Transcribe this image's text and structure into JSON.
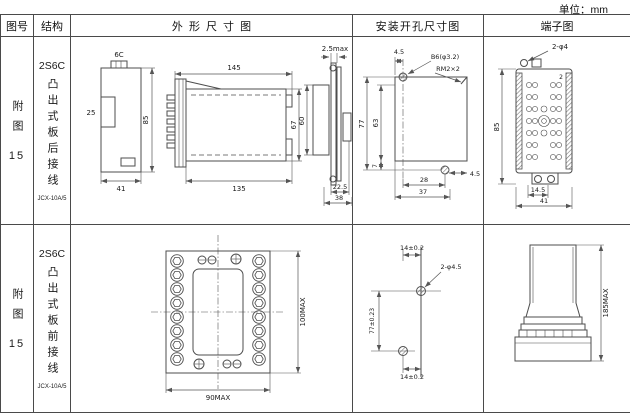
{
  "page": {
    "unit_label": "单位：mm"
  },
  "table": {
    "headers": {
      "fig_no": "图号",
      "structure": "结构",
      "outline": "外形尺寸图",
      "mounting": "安装开孔尺寸图",
      "terminal": "端子图"
    },
    "rows": [
      {
        "fig_label": "附图",
        "fig_num": "15",
        "model": "2S6C",
        "mount_text": "凸出式板后接线",
        "type": "JCX-10A/5",
        "outline": {
          "a_label": "6C",
          "a_left": "25",
          "a_right": "85",
          "a_bottom": "41",
          "b_top": "145",
          "b_bottom": "135",
          "b_right": "67",
          "c_top": "2.5max",
          "c_left": "60",
          "c_b1": "22.5",
          "c_b2": "38"
        },
        "mounting": {
          "top": "4.5",
          "hole_label": "B6(φ3.2)",
          "thread_label": "RM2×2",
          "left_outer": "77",
          "left_inner": "63",
          "bottom_small": "7",
          "bottom_inner": "28",
          "right": "4.5",
          "bottom_outer": "37"
        },
        "terminal": {
          "hole_label": "2-φ4",
          "num": "2",
          "left": "85",
          "b1": "14.5",
          "b2": "41"
        }
      },
      {
        "fig_label": "附图",
        "fig_num": "15",
        "model": "2S6C",
        "mount_text": "凸出式板前接线",
        "type": "JCX-10A/5",
        "outline": {
          "right": "100MAX",
          "bottom": "90MAX"
        },
        "mounting": {
          "top": "14±0.2",
          "hole_label": "2-φ4.5",
          "left": "77±0.23",
          "bottom": "14±0.2"
        },
        "terminal": {
          "right": "185MAX"
        }
      }
    ]
  }
}
